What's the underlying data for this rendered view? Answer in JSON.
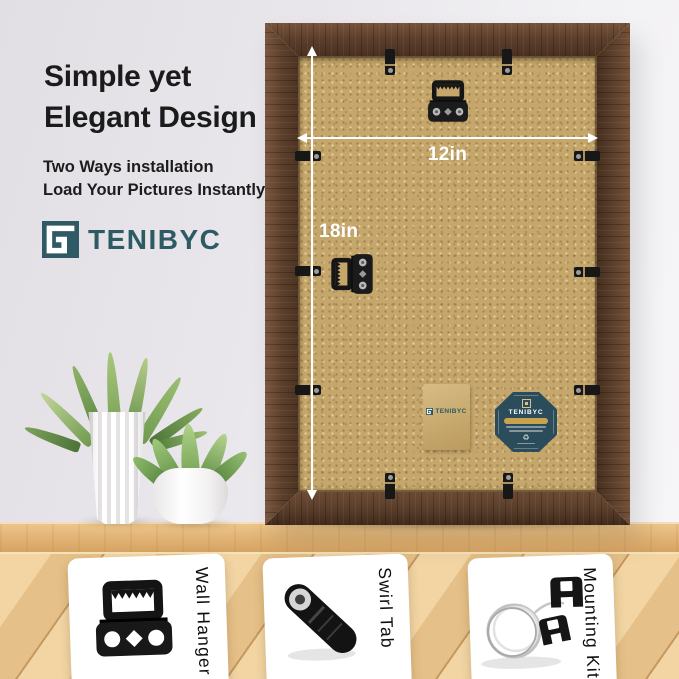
{
  "brand": {
    "name": "TENIBYC",
    "teal": "#2d5a64"
  },
  "header": {
    "title_line1": "Simple yet",
    "title_line2": "Elegant Design",
    "subtitle_line1": "Two Ways installation",
    "subtitle_line2": "Load Your Pictures Instantly"
  },
  "frame": {
    "width_label": "12in",
    "height_label": "18in"
  },
  "callouts": [
    {
      "label": "Wall Hanger",
      "icon": "sawtooth-wall-hanger"
    },
    {
      "label": "Swirl Tab",
      "icon": "swivel-tab"
    },
    {
      "label": "Mounting Kit",
      "icon": "wire-and-hooks"
    }
  ],
  "colors": {
    "wall": "#e9e7eb",
    "frame_wood": "#5d402c",
    "backboard": "#c5a76c",
    "shelf_wood": "#e0b172",
    "floor_wood": "#ecca94",
    "badge_navy": "#2b4c5b",
    "badge_gold": "#c9a24b",
    "arrow": "#ffffff",
    "card_bg": "#ffffff"
  }
}
